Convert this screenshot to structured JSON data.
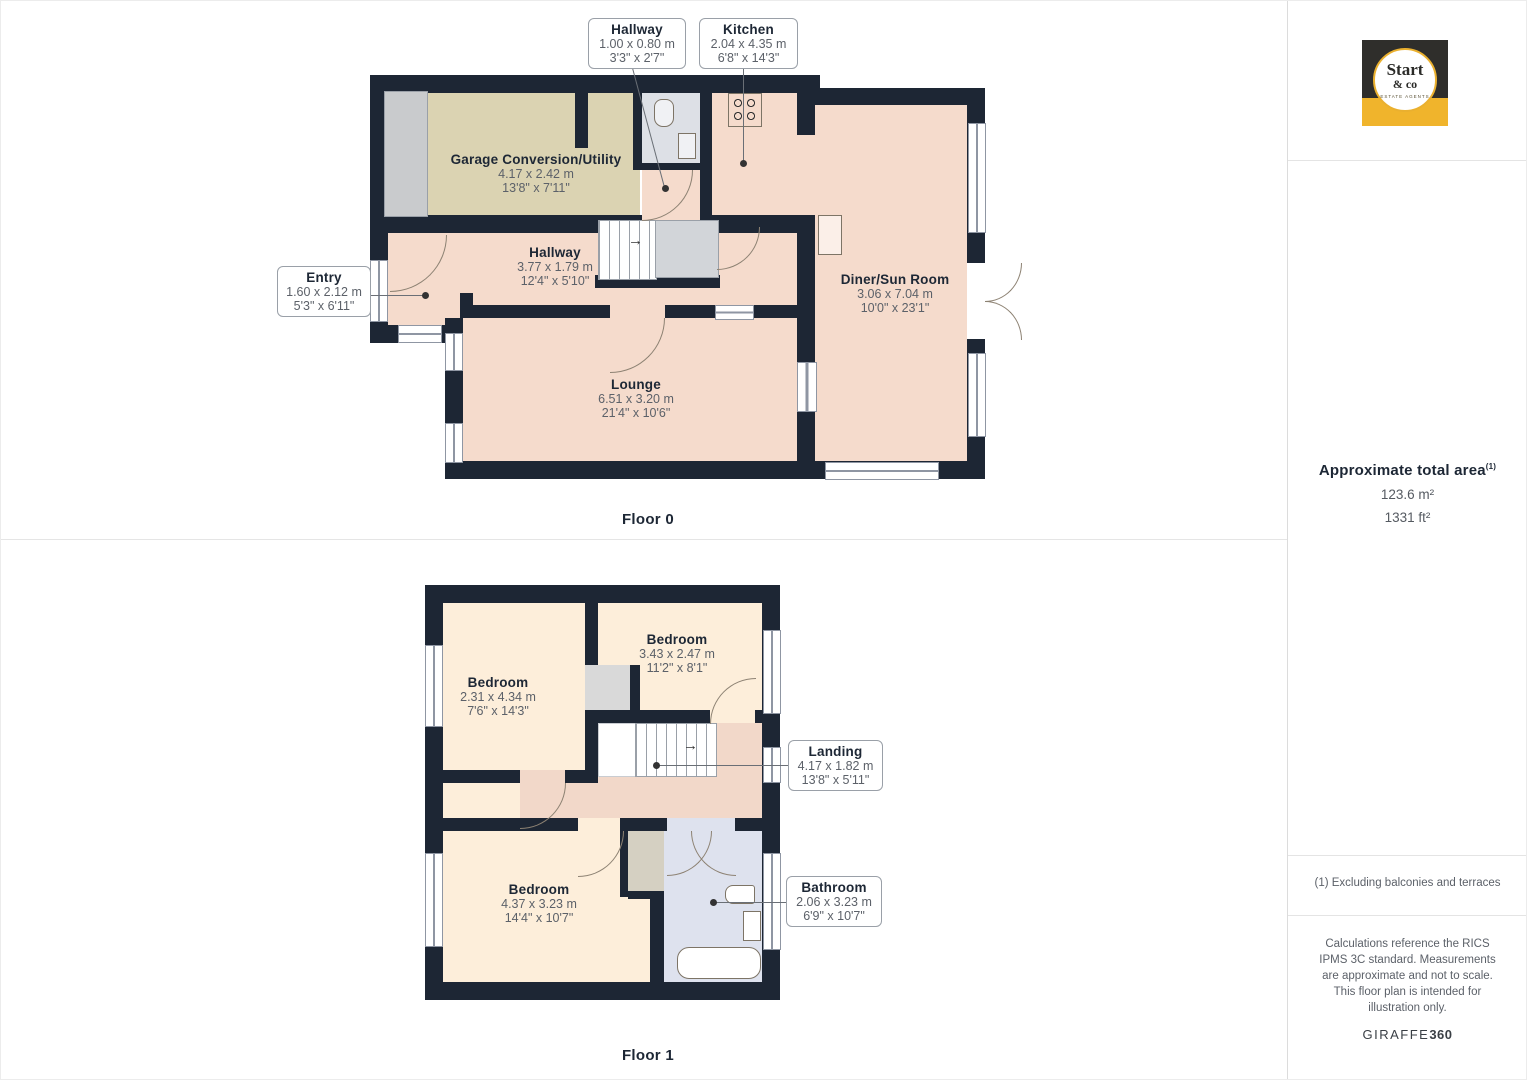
{
  "colors": {
    "wall": "#1d2634",
    "floor0_room": "#f5dbcc",
    "garage_room": "#dbd3b2",
    "floor1_room": "#fdeeda",
    "landing_room": "#f2d8c9",
    "bathroom_room": "#dee2ee",
    "stair_gray": "#d2d5d9",
    "logo_yellow": "#f0b42c",
    "logo_dark": "#2f2e2b"
  },
  "floor0": {
    "label": "Floor 0",
    "rooms": [
      {
        "name": "Garage Conversion/Utility",
        "metric": "4.17 x 2.42 m",
        "imperial": "13'8\" x 7'11\""
      },
      {
        "name": "Hallway",
        "metric": "3.77 x 1.79 m",
        "imperial": "12'4\" x 5'10\""
      },
      {
        "name": "Lounge",
        "metric": "6.51 x 3.20 m",
        "imperial": "21'4\" x 10'6\""
      },
      {
        "name": "Diner/Sun Room",
        "metric": "3.06 x 7.04 m",
        "imperial": "10'0\" x 23'1\""
      }
    ],
    "callouts": [
      {
        "name": "Hallway",
        "metric": "1.00 x 0.80 m",
        "imperial": "3'3\" x 2'7\""
      },
      {
        "name": "Kitchen",
        "metric": "2.04 x 4.35 m",
        "imperial": "6'8\" x 14'3\""
      },
      {
        "name": "Entry",
        "metric": "1.60 x 2.12 m",
        "imperial": "5'3\" x 6'11\""
      }
    ]
  },
  "floor1": {
    "label": "Floor 1",
    "rooms": [
      {
        "name": "Bedroom",
        "metric": "2.31 x 4.34 m",
        "imperial": "7'6\" x 14'3\""
      },
      {
        "name": "Bedroom",
        "metric": "3.43 x 2.47 m",
        "imperial": "11'2\" x 8'1\""
      },
      {
        "name": "Bedroom",
        "metric": "4.37 x 3.23 m",
        "imperial": "14'4\" x 10'7\""
      }
    ],
    "callouts": [
      {
        "name": "Landing",
        "metric": "4.17 x 1.82 m",
        "imperial": "13'8\" x 5'11\""
      },
      {
        "name": "Bathroom",
        "metric": "2.06 x 3.23 m",
        "imperial": "6'9\" x 10'7\""
      }
    ]
  },
  "icons": {
    "direction_arrow": "→"
  },
  "sidebar": {
    "logo": {
      "name_line1": "Start",
      "name_line2": "& co",
      "tagline": "ESTATE AGENTS"
    },
    "area": {
      "title": "Approximate total area",
      "superscript": "(1)",
      "metric": "123.6 m²",
      "imperial": "1331 ft²"
    },
    "footnote": "(1) Excluding balconies and terraces",
    "disclaimer": "Calculations reference the RICS IPMS 3C standard. Measurements are approximate and not to scale. This floor plan is intended for illustration only.",
    "brand": {
      "name": "GIRAFFE",
      "suffix": "360"
    }
  }
}
